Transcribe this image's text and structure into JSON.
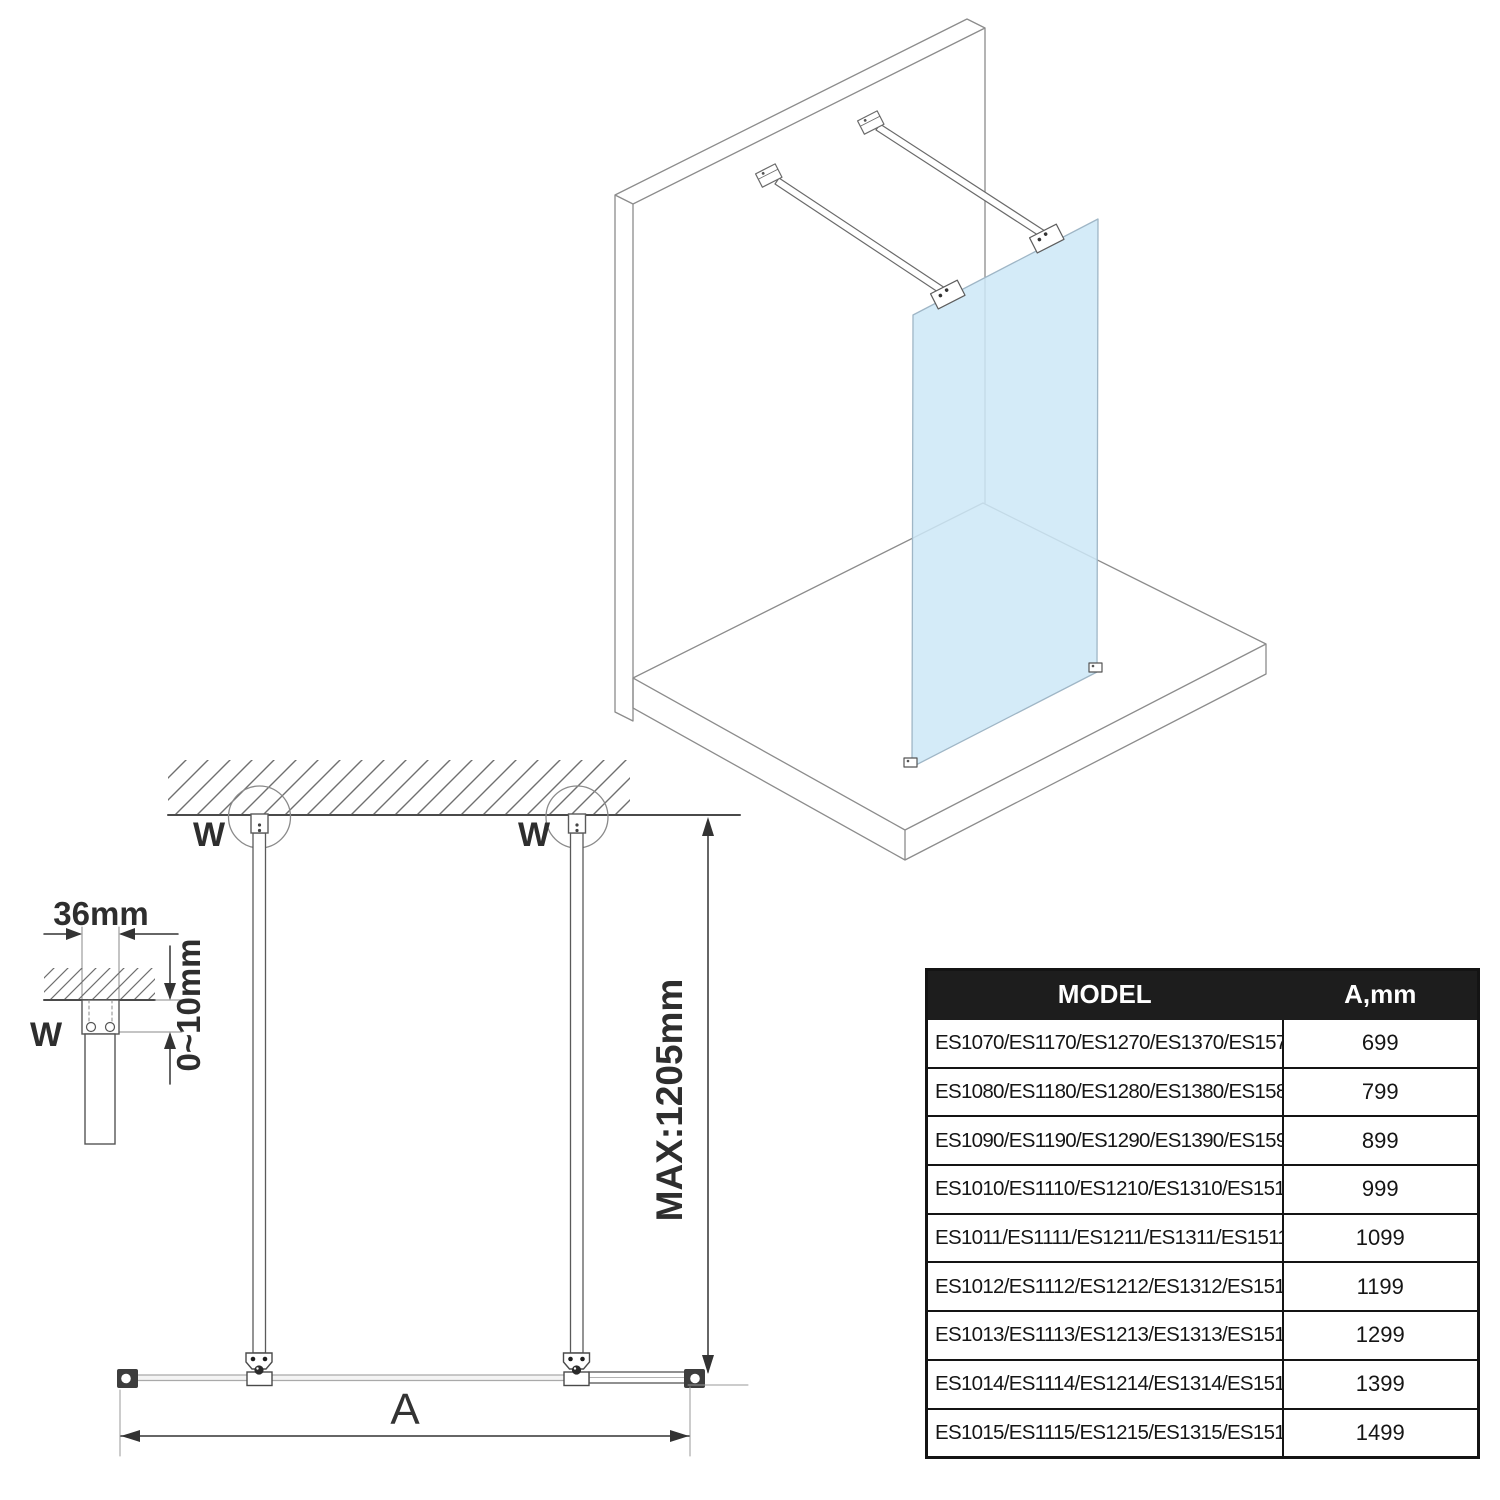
{
  "views": {
    "isometric": {
      "description": "walk-in glass shower panel fixed to back wall with two support bars, standing on shower tray",
      "glass_color": "#cce8f7"
    },
    "plan_view": {
      "wall_anchor_labels": [
        "W",
        "W"
      ],
      "max_bar_length_label": "MAX:1205mm",
      "glass_width_label": "A"
    },
    "bracket_detail": {
      "wall_anchor_label": "W",
      "bracket_width_label": "36mm",
      "adjustment_range_label": "0~10mm"
    }
  },
  "table": {
    "headers": [
      "MODEL",
      "A,mm"
    ],
    "rows": [
      {
        "model": "ES1070/ES1170/ES1270/ES1370/ES1570",
        "a_mm": "699"
      },
      {
        "model": "ES1080/ES1180/ES1280/ES1380/ES1580",
        "a_mm": "799"
      },
      {
        "model": "ES1090/ES1190/ES1290/ES1390/ES1590",
        "a_mm": "899"
      },
      {
        "model": "ES1010/ES1110/ES1210/ES1310/ES1510",
        "a_mm": "999"
      },
      {
        "model": "ES1011/ES1111/ES1211/ES1311/ES1511",
        "a_mm": "1099"
      },
      {
        "model": "ES1012/ES1112/ES1212/ES1312/ES1512",
        "a_mm": "1199"
      },
      {
        "model": "ES1013/ES1113/ES1213/ES1313/ES1513",
        "a_mm": "1299"
      },
      {
        "model": "ES1014/ES1114/ES1214/ES1314/ES1514",
        "a_mm": "1399"
      },
      {
        "model": "ES1015/ES1115/ES1215/ES1315/ES1515",
        "a_mm": "1499"
      }
    ]
  },
  "colors": {
    "glass": "#cce8f7",
    "iso_line": "#8c8c8c",
    "drawing_line": "#4a4a4a",
    "table_header_bg": "#1d1d1d",
    "table_header_text": "#ffffff"
  }
}
